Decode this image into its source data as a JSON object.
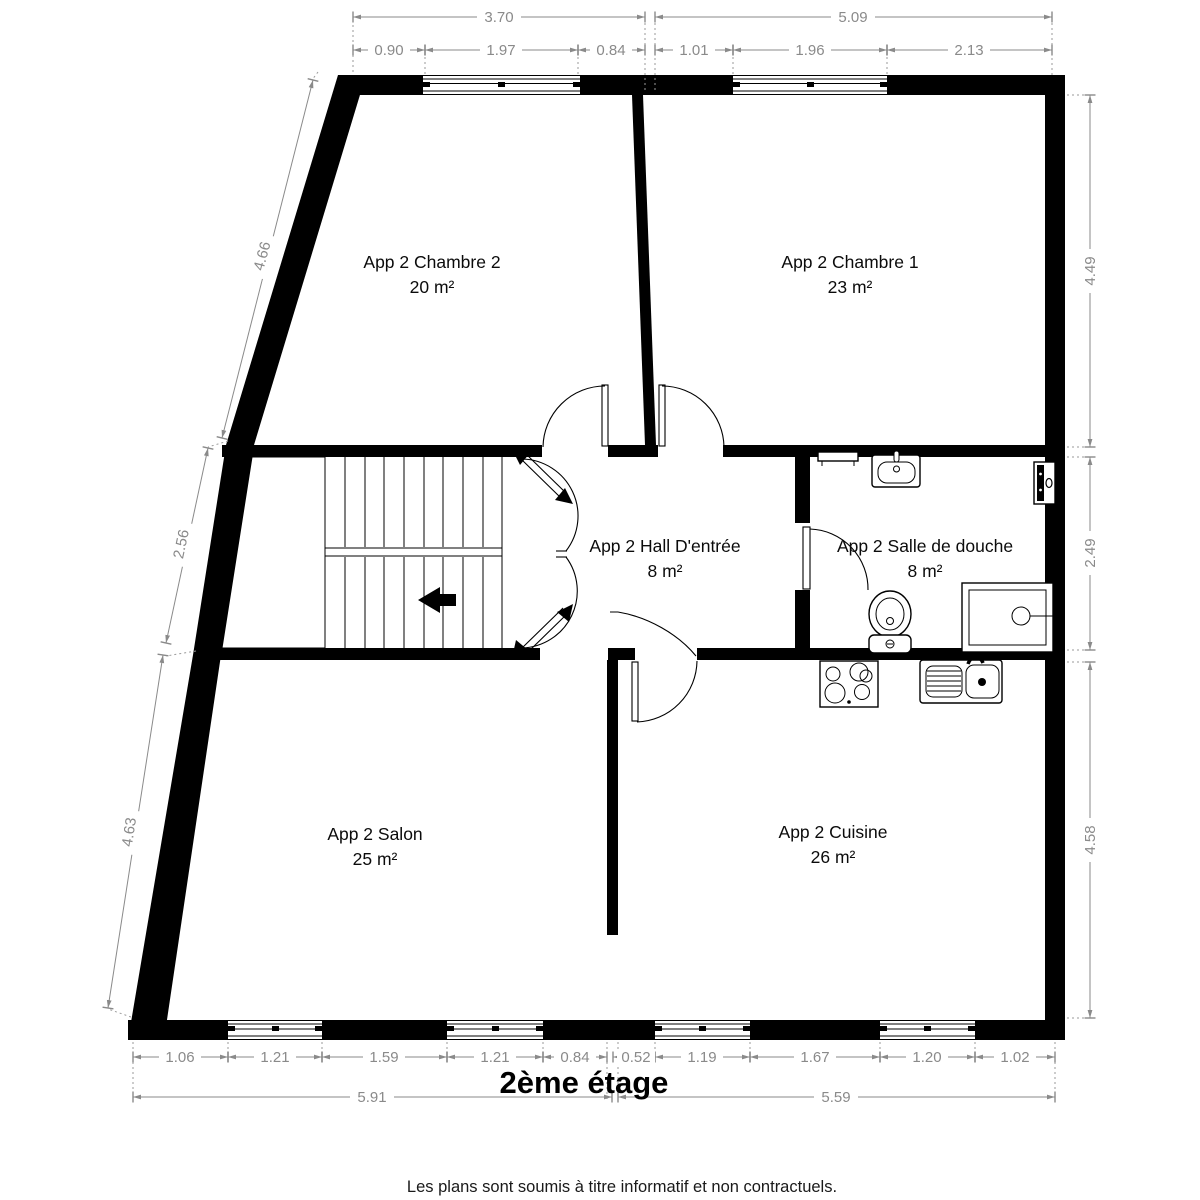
{
  "title": "2ème étage",
  "footer": "Les plans sont soumis à titre informatif et non contractuels.",
  "rooms": [
    {
      "name": "App 2 Chambre 2",
      "area": "20 m²"
    },
    {
      "name": "App 2 Chambre 1",
      "area": "23 m²"
    },
    {
      "name": "App 2 Hall D'entrée",
      "area": "8 m²"
    },
    {
      "name": "App 2 Salle de douche",
      "area": "8 m²"
    },
    {
      "name": "App 2 Salon",
      "area": "25 m²"
    },
    {
      "name": "App 2 Cuisine",
      "area": "26 m²"
    }
  ],
  "dims": {
    "top_totals": [
      "3.70",
      "5.09"
    ],
    "top_segs": [
      "0.90",
      "1.97",
      "0.84",
      "1.01",
      "1.96",
      "2.13"
    ],
    "left": [
      "4.66",
      "2.56",
      "4.63"
    ],
    "right": [
      "4.49",
      "2.49",
      "4.58"
    ],
    "bottom_segs": [
      "1.06",
      "1.21",
      "1.59",
      "1.21",
      "0.84",
      "0.52",
      "1.19",
      "1.67",
      "1.20",
      "1.02"
    ],
    "bottom_totals": [
      "5.91",
      "5.59"
    ]
  },
  "colors": {
    "wall": "#000000",
    "dimension": "#8a8a8a",
    "background": "#ffffff"
  },
  "icons": [
    "stairs-icon",
    "direction-arrow-icon",
    "sink-icon",
    "toilet-icon",
    "shower-icon",
    "stove-icon",
    "kitchen-sink-icon",
    "radiator-icon",
    "boiler-icon",
    "door-swing-icon",
    "window-icon"
  ]
}
